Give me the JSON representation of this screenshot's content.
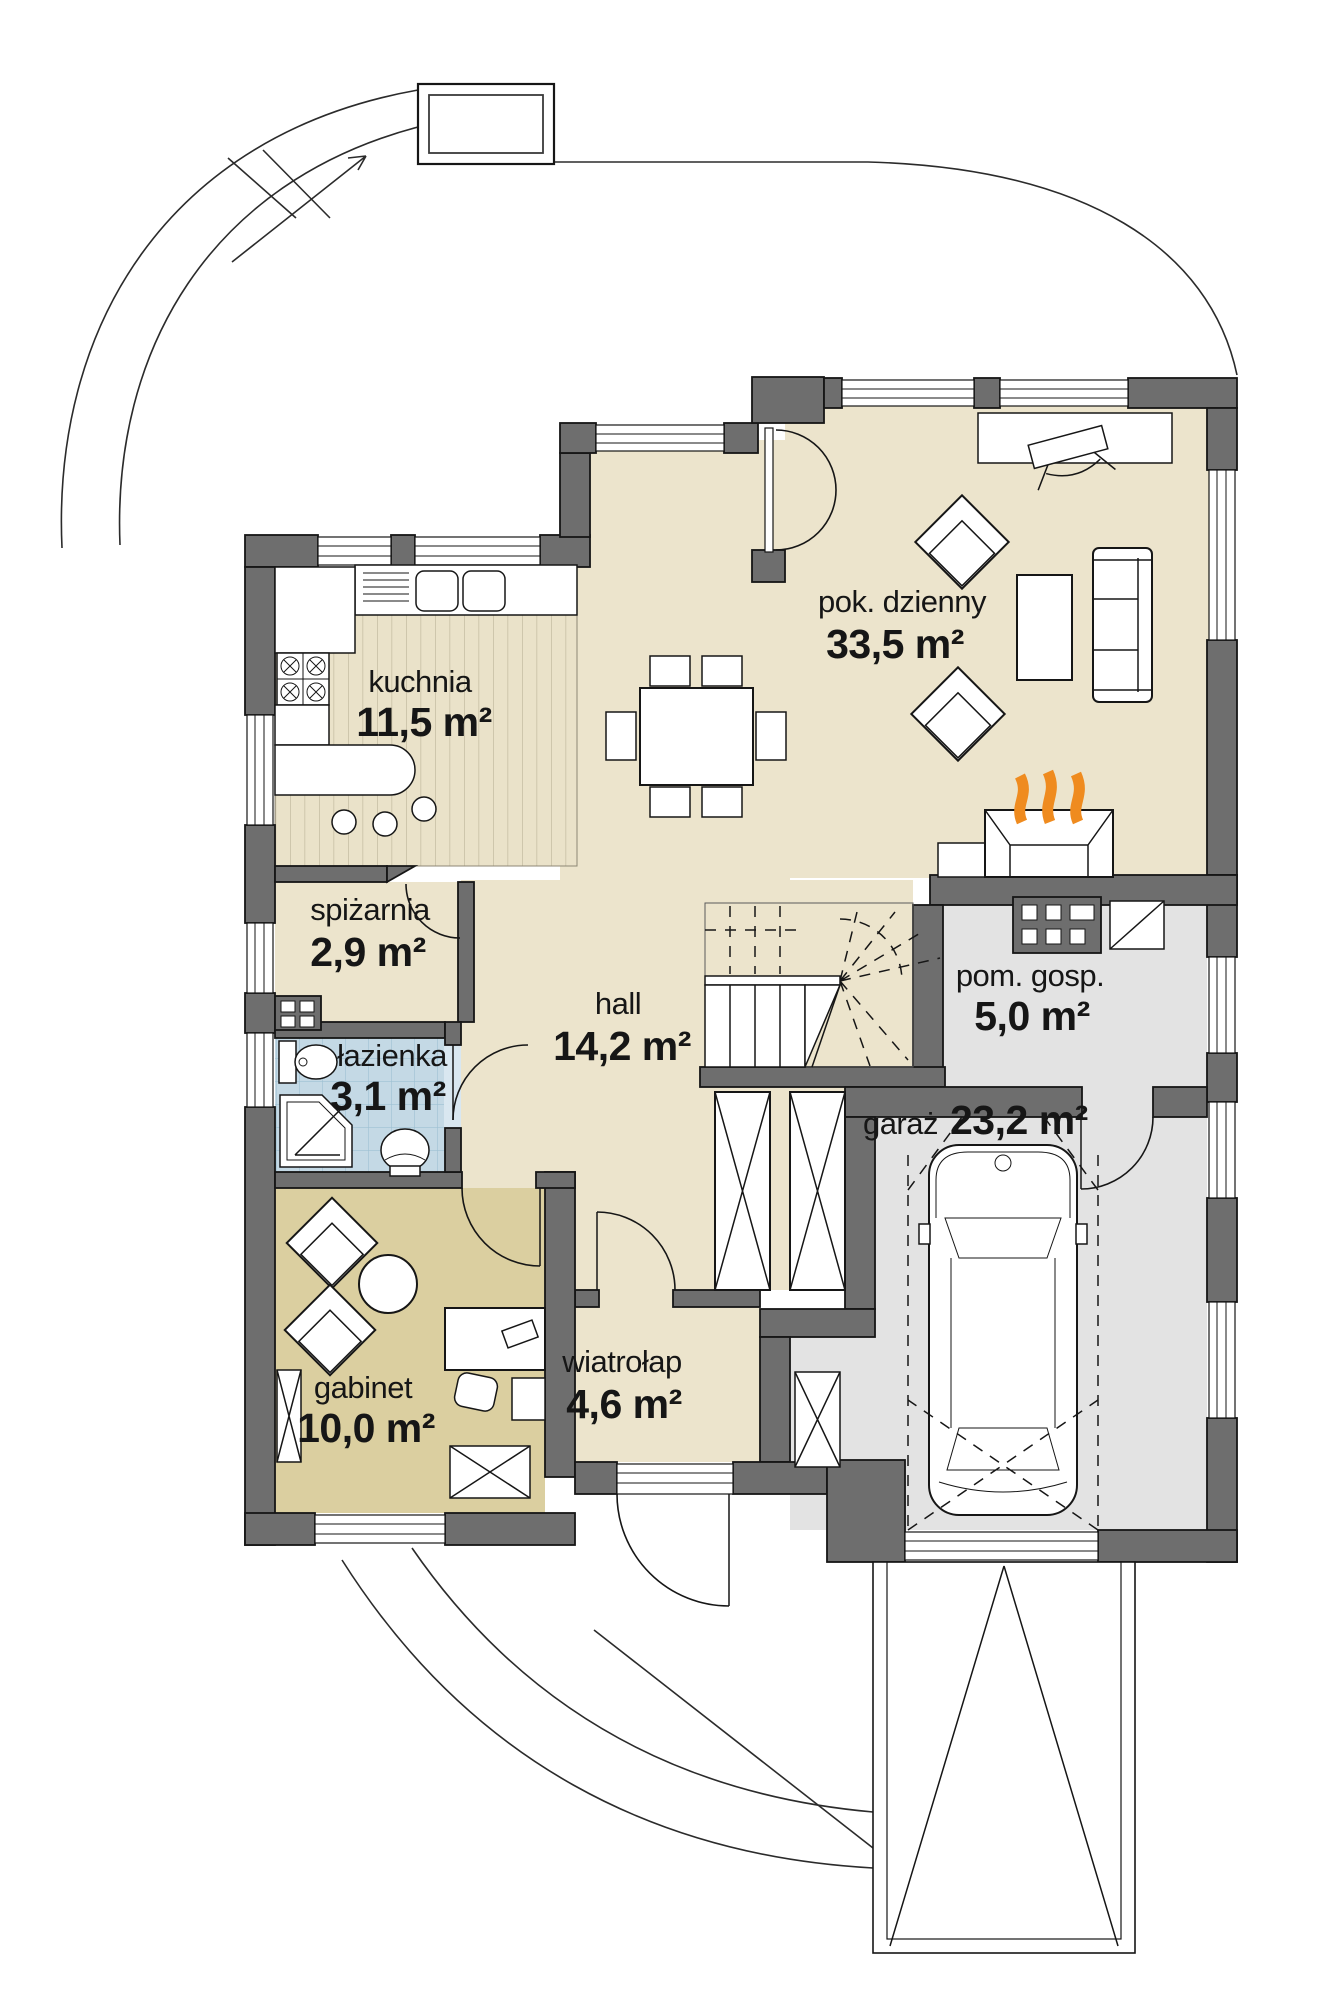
{
  "plan": {
    "rooms": [
      {
        "name": "pok. dzienny",
        "area": "33,5 m²"
      },
      {
        "name": "kuchnia",
        "area": "11,5 m²"
      },
      {
        "name": "spiżarnia",
        "area": "2,9 m²"
      },
      {
        "name": "łazienka",
        "area": "3,1 m²"
      },
      {
        "name": "gabinet",
        "area": "10,0 m²"
      },
      {
        "name": "hall",
        "area": "14,2 m²"
      },
      {
        "name": "wiatrołap",
        "area": "4,6 m²"
      },
      {
        "name": "pom. gosp.",
        "area": "5,0 m²"
      },
      {
        "name": "garaż",
        "area": "23,2 m²"
      }
    ],
    "colors": {
      "wall": "#6e6e6e",
      "floor_main": "#ece4cc",
      "floor_office": "#dbcfa0",
      "floor_bath": "#c4d9e5",
      "floor_garage": "#e3e3e3",
      "flame": "#ef8b1f",
      "line": "#161616"
    }
  }
}
